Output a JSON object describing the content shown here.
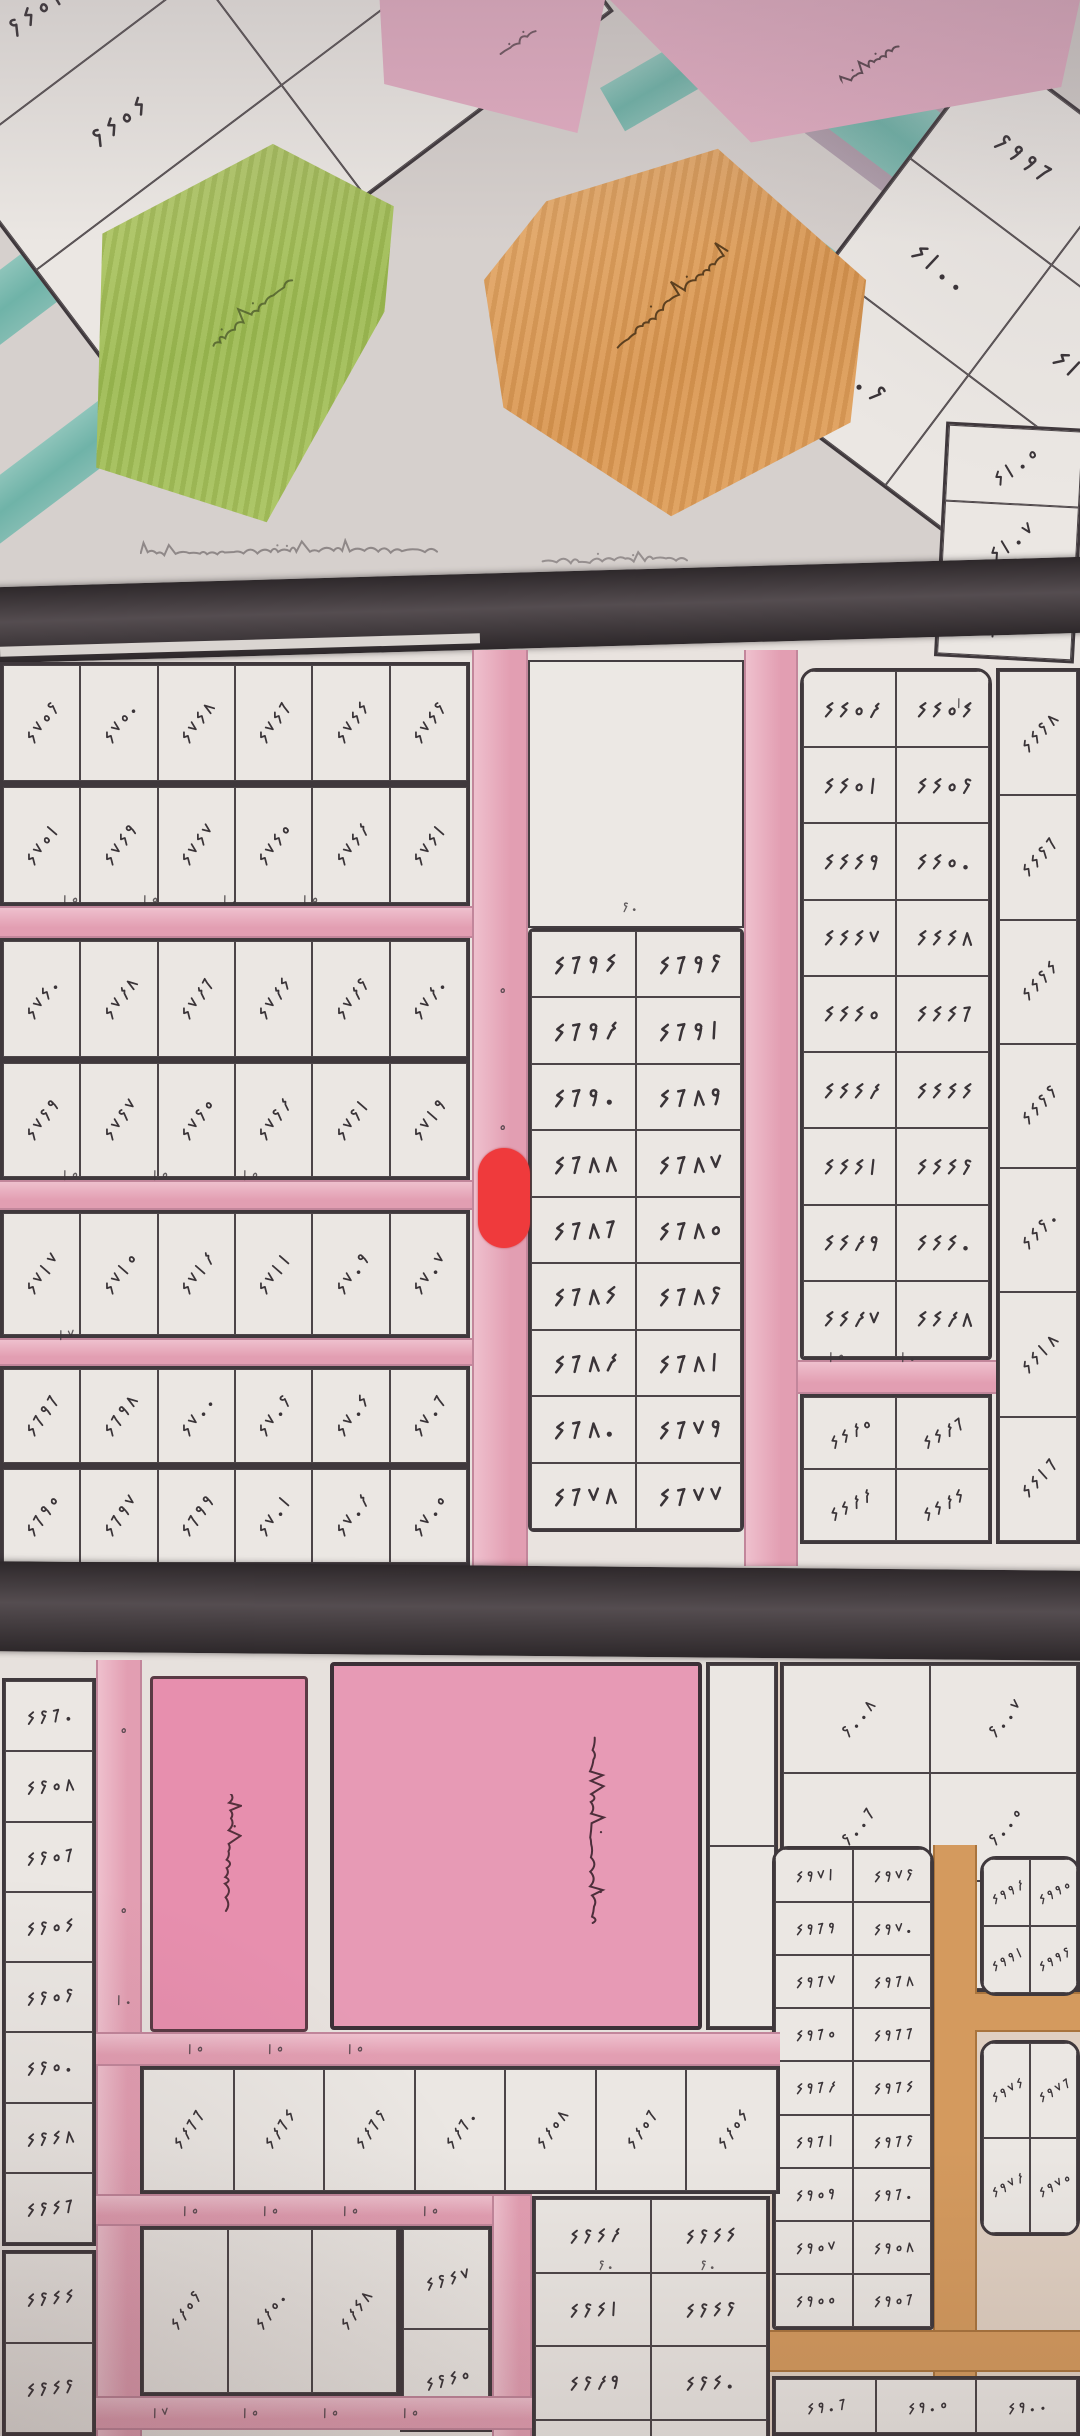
{
  "image_type": "hand-drawn cadastral plot map photograph",
  "marker": {
    "shape": "rounded-rect",
    "color": "#ef3a3c"
  },
  "palette": {
    "paper": "#d8d2cf",
    "plot_fill": "#ebe7e3",
    "ink": "#3a3438",
    "street_pink": "#e9abbd",
    "road_dark": "#474043",
    "road_orange": "#d49a5e",
    "zone_green": "#a9c25d",
    "zone_orange": "#dfa061",
    "zone_pink": "#e3aec3",
    "zone_teal": "#7fbdb2",
    "school_pink": "#e794b2",
    "marker_red": "#ef3a3c"
  },
  "zone_labels": {
    "commercial": "مناطق تجارية",
    "kindergarten": "روضة",
    "park": "حديقة",
    "nursery": "حضانة",
    "school": "مدرسة البنين"
  },
  "top_left_grid": [
    [
      "٢٤٥١",
      "٢٤٥٢"
    ],
    [
      "٢٤٥٤",
      "٢٤٥٥"
    ],
    [
      "٢٤٥٦",
      "٢٤٥٧"
    ]
  ],
  "top_right_grid": [
    [
      "٢٩٩٦",
      "٢٩٩٨"
    ],
    [
      "٤١٠٠",
      "٤١٠١"
    ],
    [
      "٤١٠٢",
      "٤١٠٤"
    ]
  ],
  "right_strip": [
    "٤١٠٥",
    "٤١٠٧",
    "٤١٠٩"
  ],
  "strips": {
    "s1a": [
      "٤٧٥٢",
      "٤٧٥٠",
      "٤٧٤٨",
      "٤٧٤٦",
      "٤٧٤٤",
      "٤٧٤٢"
    ],
    "s1b": [
      "٤٧٥١",
      "٤٧٤٩",
      "٤٧٤٧",
      "٤٧٤٥",
      "٤٧٤٣",
      "٤٧٤١"
    ],
    "s2a": [
      "٤٧٤٠",
      "٤٧٣٨",
      "٤٧٣٦",
      "٤٧٣٤",
      "٤٧٣٢",
      "٤٧٣٠"
    ],
    "s2b": [
      "٤٧٢٩",
      "٤٧٢٧",
      "٤٧٢٥",
      "٤٧٢٣",
      "٤٧٢١",
      "٤٧١٩"
    ],
    "s3": [
      "٤٧١٧",
      "٤٧١٥",
      "٤٧١٣",
      "٤٧١١",
      "٤٧٠٩",
      "٤٧٠٧"
    ],
    "s4a": [
      "٤٦٩٦",
      "٤٦٩٨",
      "٤٧٠٠",
      "٤٧٠٢",
      "٤٧٠٤",
      "٤٧٠٦"
    ],
    "s4b": [
      "٤٦٩٥",
      "٤٦٩٧",
      "٤٦٩٩",
      "٤٧٠١",
      "٤٧٠٣",
      "٤٧٠٥"
    ]
  },
  "central_block": [
    [
      "٤٦٩٤",
      "٤٦٩٢"
    ],
    [
      "٤٦٩٣",
      "٤٦٩١"
    ],
    [
      "٤٦٩٠",
      "٤٦٨٩"
    ],
    [
      "٤٦٨٨",
      "٤٦٨٧"
    ],
    [
      "٤٦٨٦",
      "٤٦٨٥"
    ],
    [
      "٤٦٨٤",
      "٤٦٨٢"
    ],
    [
      "٤٦٨٣",
      "٤٦٨١"
    ],
    [
      "٤٦٨٠",
      "٤٦٧٩"
    ],
    [
      "٤٦٧٨",
      "٤٦٧٧"
    ]
  ],
  "right_block": [
    [
      "٤٤٥٣",
      "٤٤٥٤"
    ],
    [
      "٤٤٥١",
      "٤٤٥٢"
    ],
    [
      "٤٤٤٩",
      "٤٤٥٠"
    ],
    [
      "٤٤٤٧",
      "٤٤٤٨"
    ],
    [
      "٤٤٤٥",
      "٤٤٤٦"
    ],
    [
      "٤٤٤٣",
      "٤٤٤٤"
    ],
    [
      "٤٤٤١",
      "٤٤٤٢"
    ],
    [
      "٤٤٣٩",
      "٤٤٤٠"
    ],
    [
      "٤٤٣٧",
      "٤٤٣٨"
    ]
  ],
  "right_block_lower": [
    [
      "٤٤٣٥",
      "٤٤٣٦"
    ],
    [
      "٤٤٣٣",
      "٤٤٣٤"
    ]
  ],
  "far_right_column": [
    "٤٤٢٨",
    "٤٤٢٦",
    "٤٤٢٤",
    "٤٤٢٢",
    "٤٤٢٠",
    "٤٤١٨",
    "٤٤١٦"
  ],
  "left_edge_column": [
    "٤٢٦٠",
    "٤٢٥٨",
    "٤٢٥٦",
    "٤٢٥٤",
    "٤٢٥٢",
    "٤٢٥٠",
    "٤٢٤٨",
    "٤٢٤٦"
  ],
  "left_edge_column2": [
    "٤٢٤٤",
    "٤٢٤٢"
  ],
  "right_upper_grid": [
    [
      "٢٠٠٨",
      "٢٠٠٧"
    ],
    [
      "٢٠٠٦",
      "٢٠٠٥"
    ],
    [
      "٢٠٠٤",
      "٢٠٠٣"
    ]
  ],
  "bottom_right_block": [
    [
      "٤٩٧١",
      "٤٩٧٢"
    ],
    [
      "٤٩٦٩",
      "٤٩٧٠"
    ],
    [
      "٤٩٦٧",
      "٤٩٦٨"
    ],
    [
      "٤٩٦٥",
      "٤٩٦٦"
    ],
    [
      "٤٩٦٣",
      "٤٩٦٤"
    ],
    [
      "٤٩٦١",
      "٤٩٦٢"
    ],
    [
      "٤٩٥٩",
      "٤٩٦٠"
    ],
    [
      "٤٩٥٧",
      "٤٩٥٨"
    ],
    [
      "٤٩٥٥",
      "٤٩٥٦"
    ]
  ],
  "bottom_right_edge": [
    "٤٩٠٦",
    "٤٩٠٥",
    "٤٩٠٠"
  ],
  "small_block_a": [
    [
      "٤٩٩٣",
      "٤٩٩٥"
    ],
    [
      "٤٩٩١",
      "٤٩٩٢"
    ]
  ],
  "small_block_b": [
    [
      "٤٩٧٤",
      "٤٩٧٦"
    ],
    [
      "٤٩٧٣",
      "٤٩٧٥"
    ]
  ],
  "bottom_left_row1": [
    "٤٣٦٦",
    "٤٣٦٤",
    "٤٣٦٢",
    "٤٣٦٠",
    "٤٣٥٨",
    "٤٣٥٦",
    "٤٣٥٤"
  ],
  "bottom_left_row2": [
    "٤٣٥٢",
    "٤٣٥٠",
    "٤٣٤٨"
  ],
  "side_column": [
    "٤٢٤٧",
    "٤٢٤٥"
  ],
  "bottom_center_block": [
    [
      "٤٢٤٣",
      "٤٢٤٤"
    ],
    [
      "٤٢٤١",
      "٤٢٤٢"
    ],
    [
      "٤٢٣٩",
      "٤٢٤٠"
    ],
    [
      "٤٢٣٧",
      "٤٢٣٨"
    ]
  ],
  "street_dimensions": [
    "١٥",
    "١٥",
    "١٠",
    "١٥",
    "١٥",
    "١٥",
    "١٥",
    "٢٠",
    "٥",
    "٥",
    "١٥",
    "١٠",
    "٥",
    "٥",
    "١٠",
    "١٥",
    "١٥",
    "١٥",
    "١٥",
    "١٥",
    "١٥",
    "١٥",
    "١٧",
    "١٥",
    "١٥",
    "١٥",
    "٢٠",
    "٢٠",
    "١٧",
    "١٠"
  ]
}
